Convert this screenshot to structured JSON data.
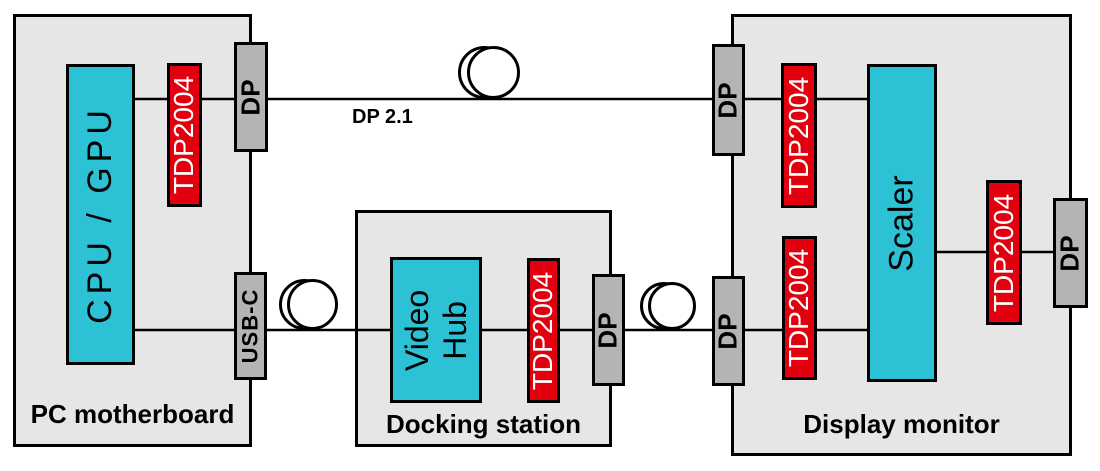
{
  "diagram": {
    "cable_label": "DP 2.1",
    "pc": {
      "label": "PC motherboard",
      "cpu": "CPU / GPU",
      "redriver": "TDP2004",
      "dp_port": "DP",
      "usbc_port": "USB-C"
    },
    "dock": {
      "label": "Docking station",
      "hub": "Video Hub",
      "redriver": "TDP2004",
      "dp_port": "DP"
    },
    "display": {
      "label": "Display monitor",
      "scaler": "Scaler",
      "redriver_top": "TDP2004",
      "redriver_bottom": "TDP2004",
      "redriver_output": "TDP2004",
      "dp_in_top": "DP",
      "dp_in_bottom": "DP",
      "dp_out": "DP"
    },
    "colors": {
      "component_cyan": "#2cc1d5",
      "redriver_red": "#e2000f",
      "port_gray": "#b4b4b4",
      "box_gray": "#e6e6e6",
      "line_black": "#000000"
    }
  }
}
